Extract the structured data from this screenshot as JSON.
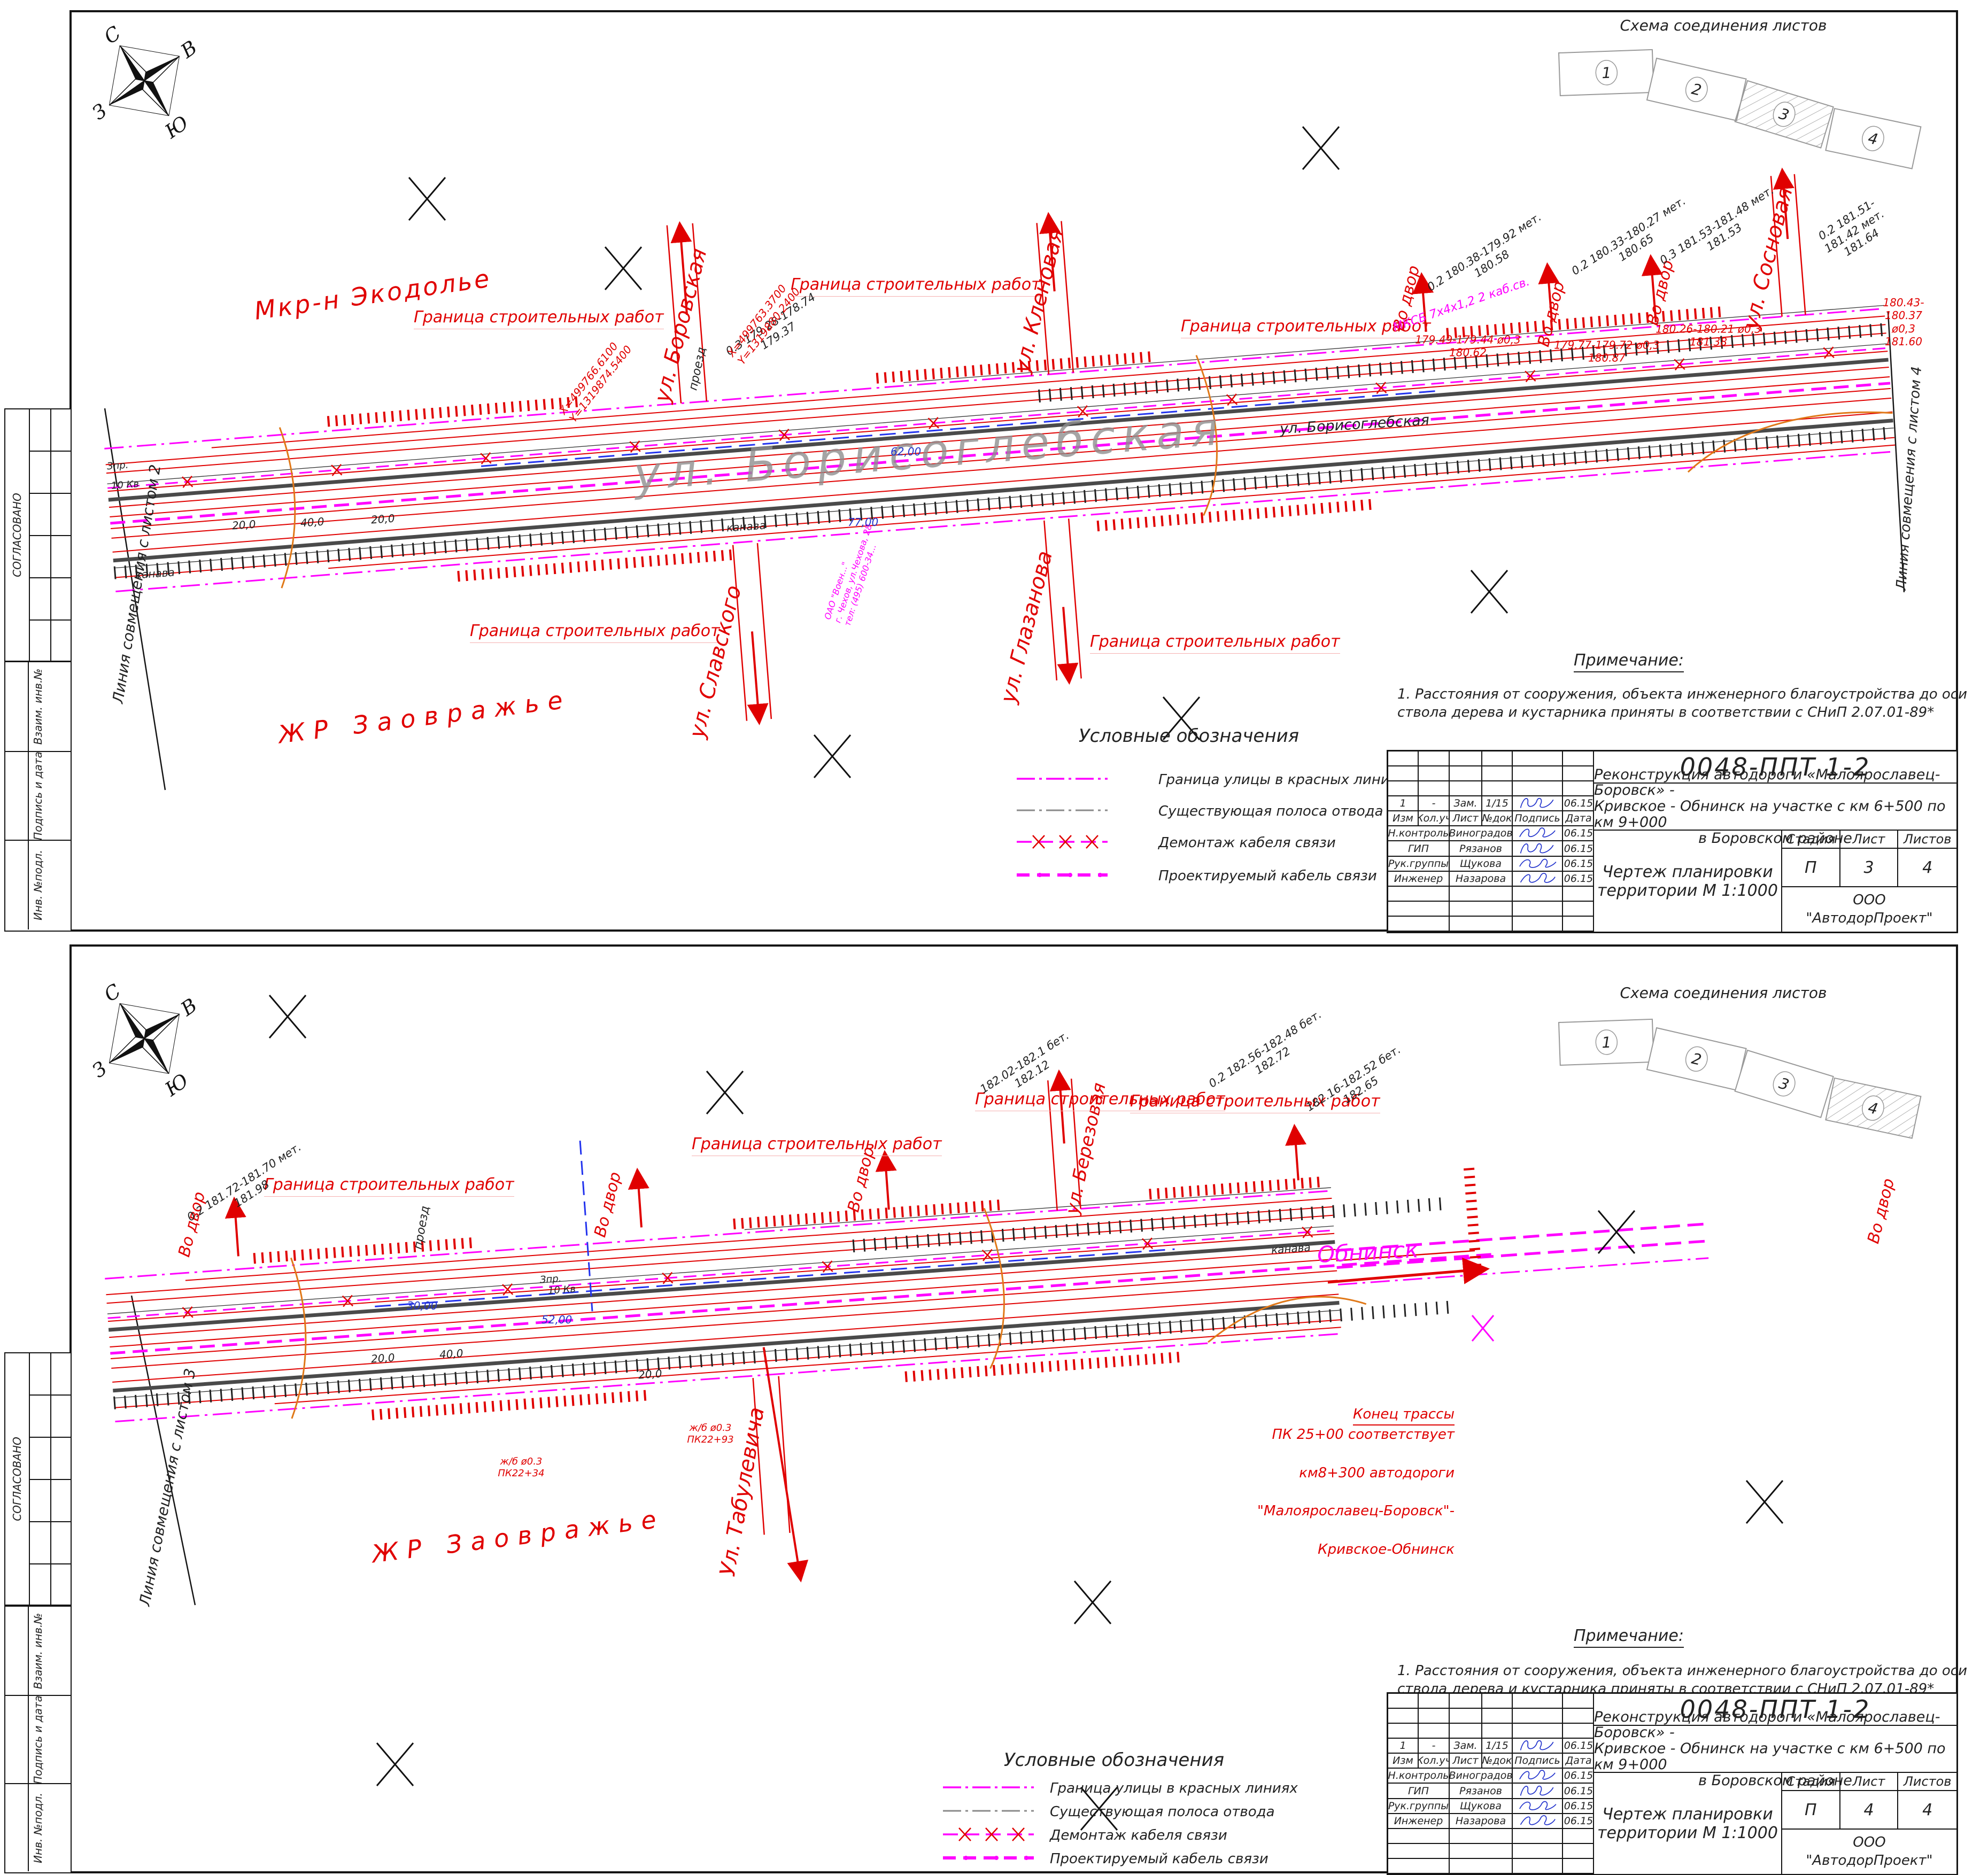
{
  "colors": {
    "red": "#e00000",
    "magenta": "#ff00ff",
    "blue_dim": "#2233cc",
    "road_gray": "#4a4a4a",
    "outline_gray": "#8f8f8f",
    "orange": "#e07818",
    "signature_blue": "#2233cc"
  },
  "compass": {
    "n": "С",
    "e": "В",
    "s": "Ю",
    "w": "З"
  },
  "frame": {
    "sogl": "СОГЛАСОВАНО",
    "vzaim": "Взаим. инв.№",
    "podp": "Подпись и дата",
    "inv": "Инв. №подл."
  },
  "scheme": {
    "title": "Схема соединения листов",
    "n1": "1",
    "n2": "2",
    "n3": "3",
    "n4": "4"
  },
  "legend": {
    "title": "Условные обозначения",
    "i1": "Граница улицы в красных линиях",
    "i2": "Существующая полоса отвода",
    "i3": "Демонтаж кабеля связи",
    "i4": "Проектируемый кабель связи"
  },
  "note": {
    "title": "Примечание:",
    "l1": "1. Расстояния от сооружения, объекта инженерного благоустройства до оси",
    "l2": "ствола дерева и кустарника приняты в соответствии с СНиП  2.07.01-89*"
  },
  "stamp": {
    "doc": "0048-ППТ 1-2",
    "t1": "Реконструкция автодороги «Малоярославец-Боровск» -",
    "t2": "Кривское - Обнинск на участке с км 6+500 по км 9+000",
    "t3": "в Боровском районе",
    "rev": {
      "c1": "1",
      "c2": "-",
      "c3": "Зам.",
      "c4": "1/15",
      "c6": "06.15"
    },
    "hdr": {
      "c1": "Изм",
      "c2": "Кол.уч",
      "c3": "Лист",
      "c4": "№док",
      "c5": "Подпись",
      "c6": "Дата"
    },
    "r1": {
      "role": "Н.контроль",
      "name": "Виноградов",
      "date": "06.15"
    },
    "r2": {
      "role": "ГИП",
      "name": "Рязанов",
      "date": "06.15"
    },
    "r3": {
      "role": "Рук.группы",
      "name": "Щукова",
      "date": "06.15"
    },
    "r4": {
      "role": "Инженер",
      "name": "Назарова",
      "date": "06.15"
    },
    "stage_h1": "Стадия",
    "stage_h2": "Лист",
    "stage_h3": "Листов",
    "stage": "П",
    "sheet1_num": "3",
    "sheet2_num": "4",
    "sheets_total": "4",
    "dr1": "Чертеж планировки",
    "dr2": "территории М 1:1000",
    "org1": "ООО",
    "org2": "\"АвтодорПроект\""
  },
  "s1": {
    "join_left": "Линия совмещения с листом 2",
    "join_right": "Линия совмещения с листом 4",
    "district_top": "Мкр-н Экодолье",
    "district_bottom": "ЖР  Заовражье",
    "street_big": "ул. Борисоглебская",
    "street_small": "ул. Борисоглебская",
    "boundary": "Граница строительных работ",
    "st1": "ул. Боровская",
    "st2": "ул. Кленовая",
    "st3": "ул. Славского",
    "st4": "ул. Глазанова",
    "st5": "ул. Сосновая",
    "vo_dvor": "Во двор",
    "e1": "0.2  180.38-179.92  мет.\n180.58",
    "e2": "0.2  180.33-180.27  мет.\n180.65",
    "e3": "0.3  181.53-181.48  мет.\n181.53",
    "e4": "0.2  181.51-181.42  мет.\n181.64",
    "e5": "0.3  179.28-178.74\n179.37",
    "p1": "179.49-179.44 ø0,3\n180.62",
    "p2": "179.77-179.72 ø0,3\n180.87",
    "p3": "180.26-180.21 ø0,3\n181.38",
    "p4": "180.43-180.37 ø0,3\n181.60",
    "coord1": "X=499766.6100\nY=1319874.5400",
    "coord2": "X=499763.3700\nY=1319880.2400",
    "cable": "МКСБ 7х4х1,2 2 каб.св.",
    "telecom": "ОАО \"Воен...\"\nг. Чехов, ул.Чехова, 28\nтел: (495) 600-34...",
    "proezd": "проезд",
    "kanava": "канава",
    "zpr": "Зпр.",
    "kv": "10 Кв",
    "d77": "77,00",
    "d62": "62,00",
    "dim1": "20,0",
    "dim2": "40,0",
    "dim3": "20,0"
  },
  "s2": {
    "join_left": "Линия совмещения с листом 3",
    "district": "ЖР  Заовражье",
    "st1": "Ул. Табулевича",
    "st2": "ул. Березовая",
    "obninsk": "Обнинск",
    "end1": "Конец трассы",
    "end2": "ПК 25+00 соответствует",
    "end3": "км8+300 автодороги",
    "end4": "\"Малоярославец-Боровск\"-",
    "end5": "Кривское-Обнинск",
    "boundary": "Граница строительных работ",
    "vo_dvor": "Во двор",
    "e1": "0.2  181.72-181.70  мет.\n181.98",
    "e2": "182.02-182.1  бет.\n182.12",
    "e3": "0.2  182.56-182.48  бет.\n182.72",
    "e4": "182.16-182.52  бет.\n182.65",
    "pk1": "ж/б ø0.3\nПК22+34",
    "pk2": "ж/б ø0.3\nПК22+93",
    "kanava": "канава",
    "proezd": "проезд",
    "zpr": "Зпр.",
    "kv": "10 Кв",
    "d30": "30,00",
    "d52": "52,00",
    "dim1": "40,0",
    "dim2": "20,0",
    "dim3": "20,0"
  }
}
